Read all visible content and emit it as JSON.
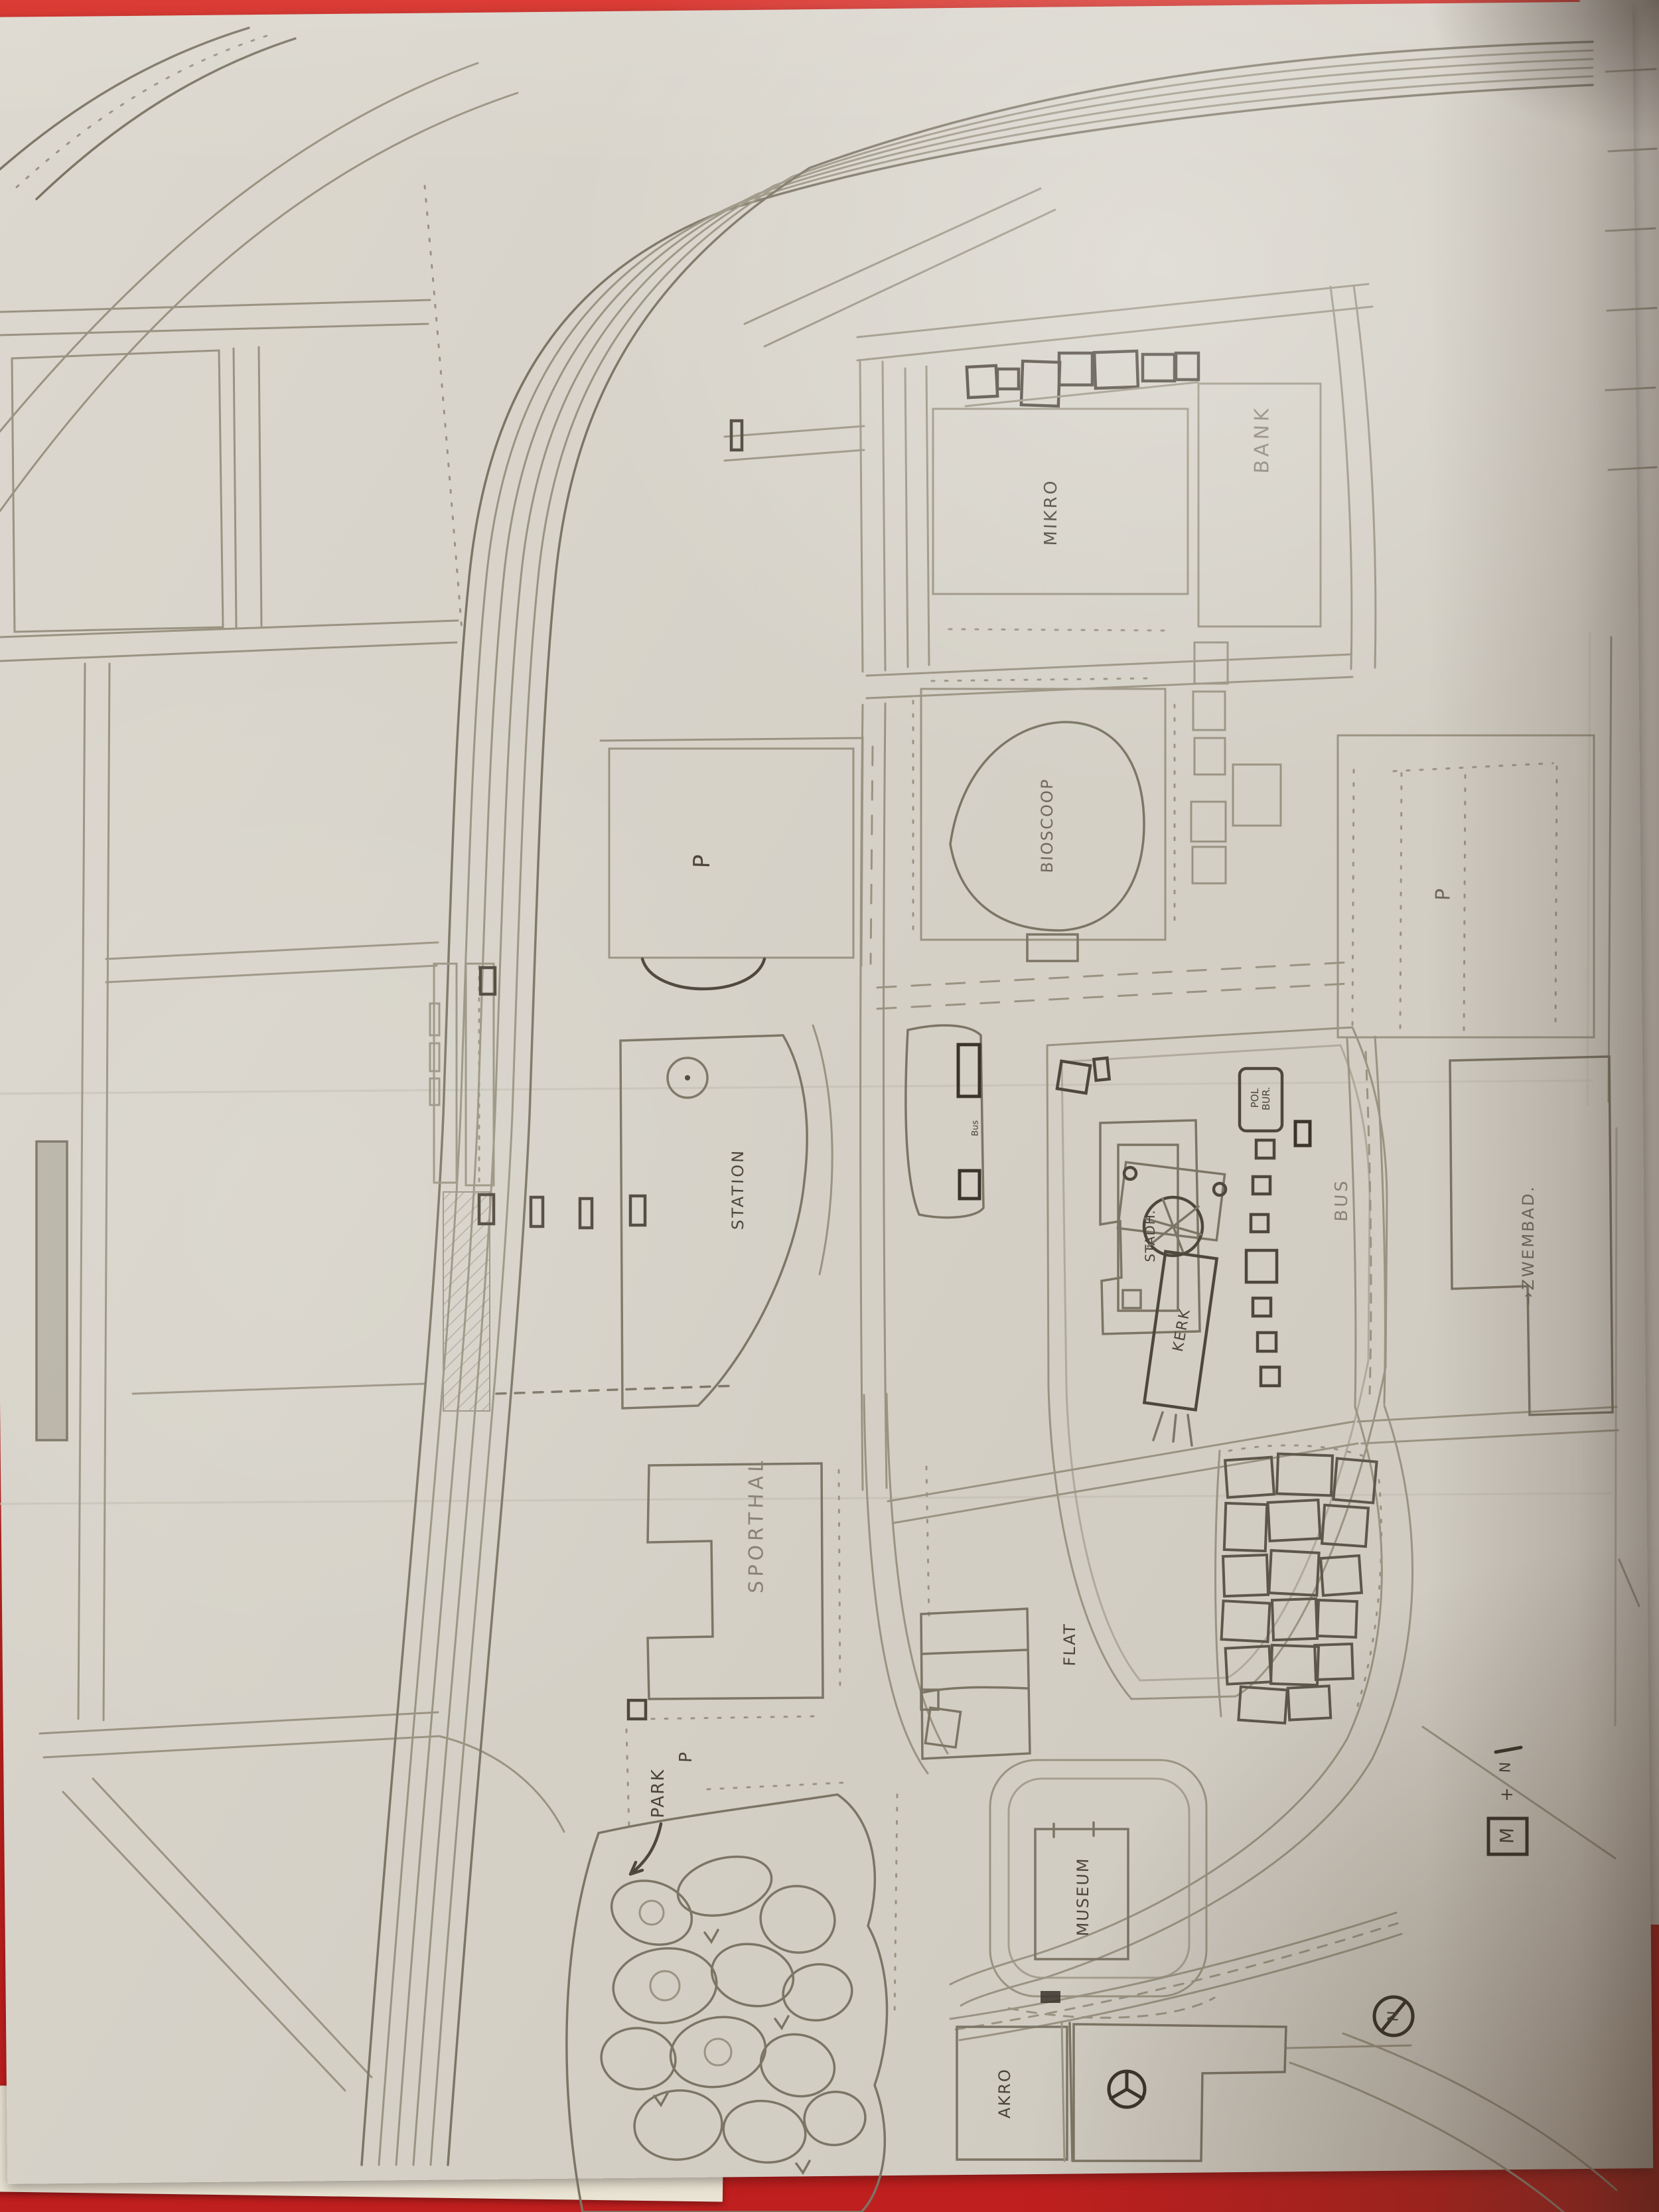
{
  "palette": {
    "table_red": "#c8201f",
    "paper": "#d6d2c8",
    "pencil_light": "#9a9382",
    "pencil_dark": "#4a443a"
  },
  "map": {
    "labels": {
      "bank": "BANK",
      "mikro": "MIKRO",
      "bioscoop": "BIOSCOOP",
      "station": "STATION",
      "sporthal": "SPORTHAL",
      "park": "PARK",
      "museum": "MUSEUM",
      "flat": "FLAT",
      "akro": "AKRO",
      "stadhuis": "STADH.",
      "kerk": "KERK",
      "politiebureau": "POL BUR.",
      "zwembad": "→ZWEMBAD.",
      "bus_road": "BUS",
      "bus_stop": "Bus"
    },
    "symbols": {
      "parking_top": "P",
      "parking_right": "P",
      "parking_park": "P",
      "compass": "N",
      "legend_box": "M",
      "legend_plus": "+",
      "legend_north": "N"
    }
  }
}
